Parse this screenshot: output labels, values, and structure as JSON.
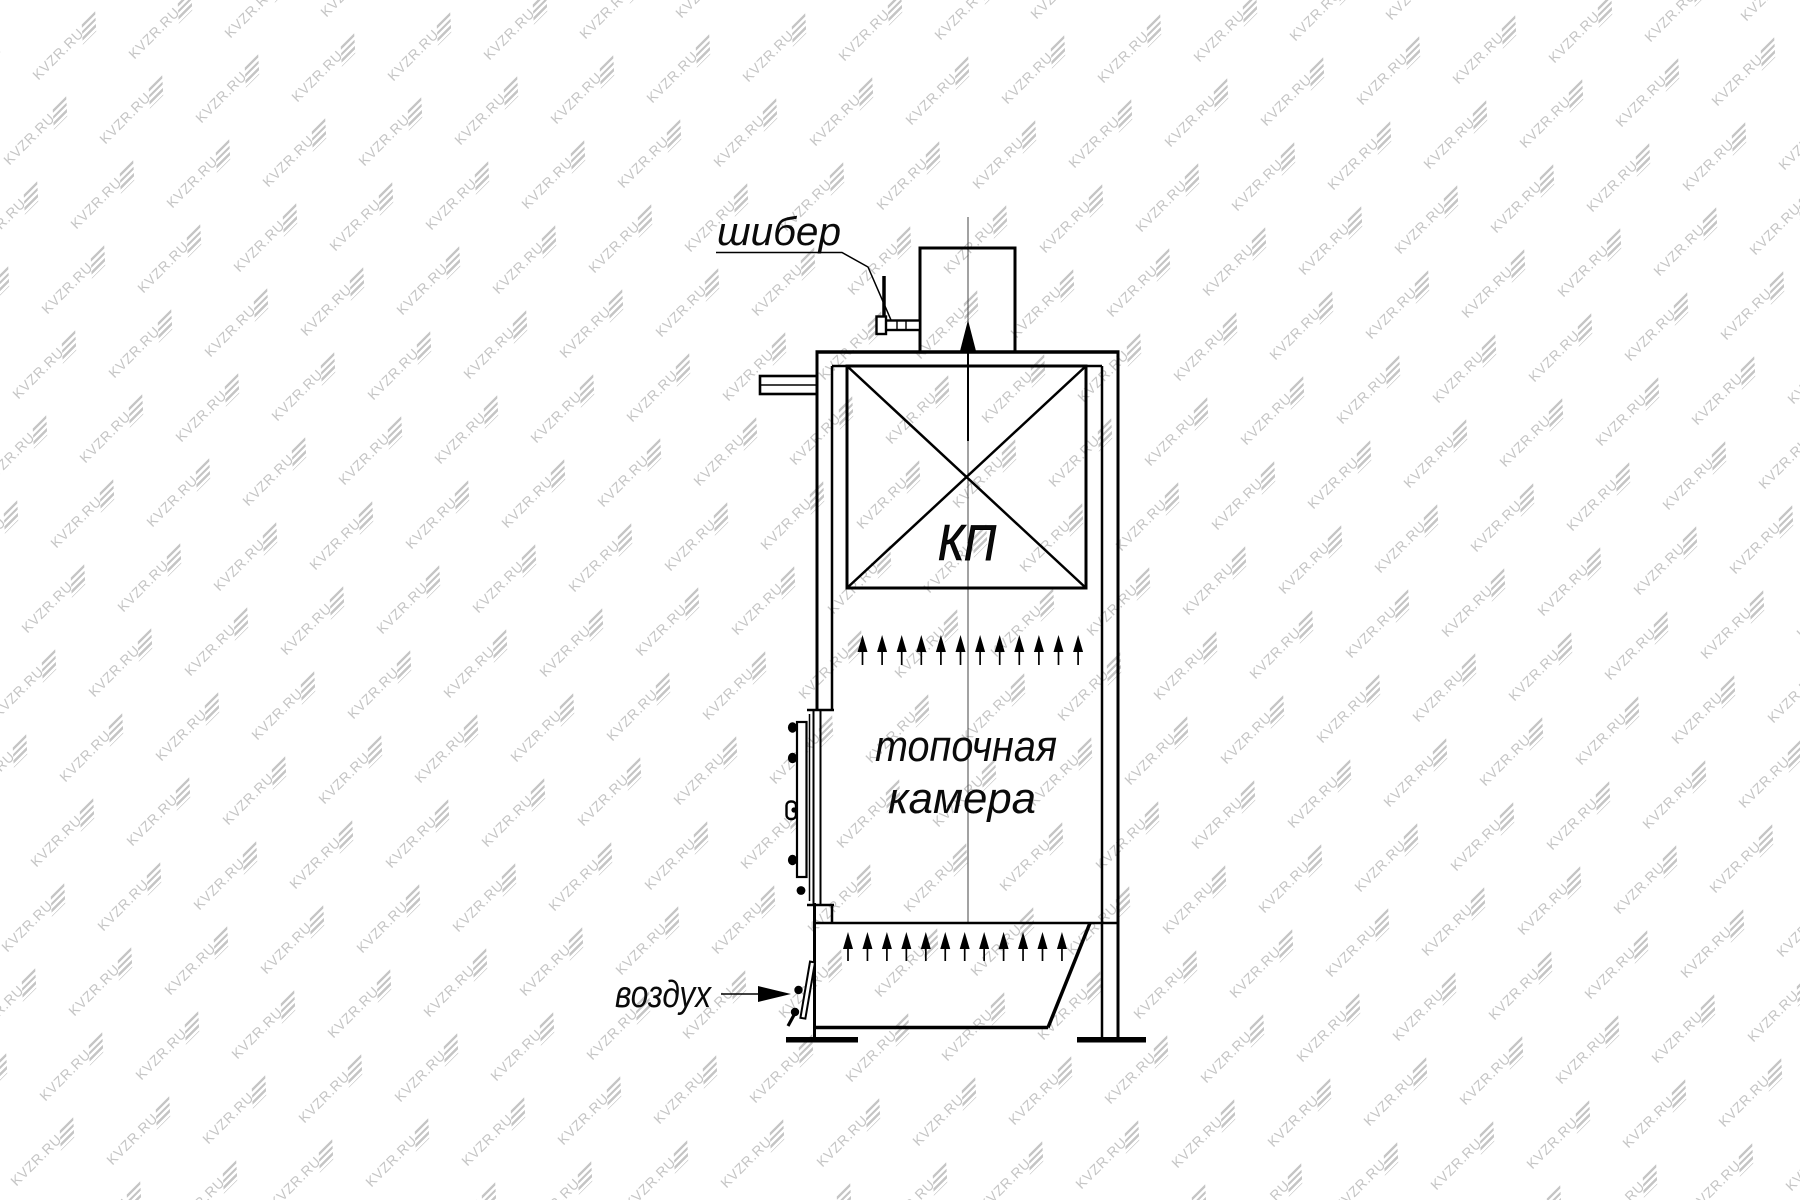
{
  "watermark": {
    "text": "KVZR.RU"
  },
  "labels": {
    "damper": "шибер",
    "convective_bundle": "КП",
    "combustion_chamber_line1": "топочная",
    "combustion_chamber_line2": "камера",
    "air": "воздух"
  },
  "colors": {
    "line": "#000000",
    "centerline": "#444444",
    "watermark": "#c5c5c5",
    "background": "#ffffff"
  }
}
